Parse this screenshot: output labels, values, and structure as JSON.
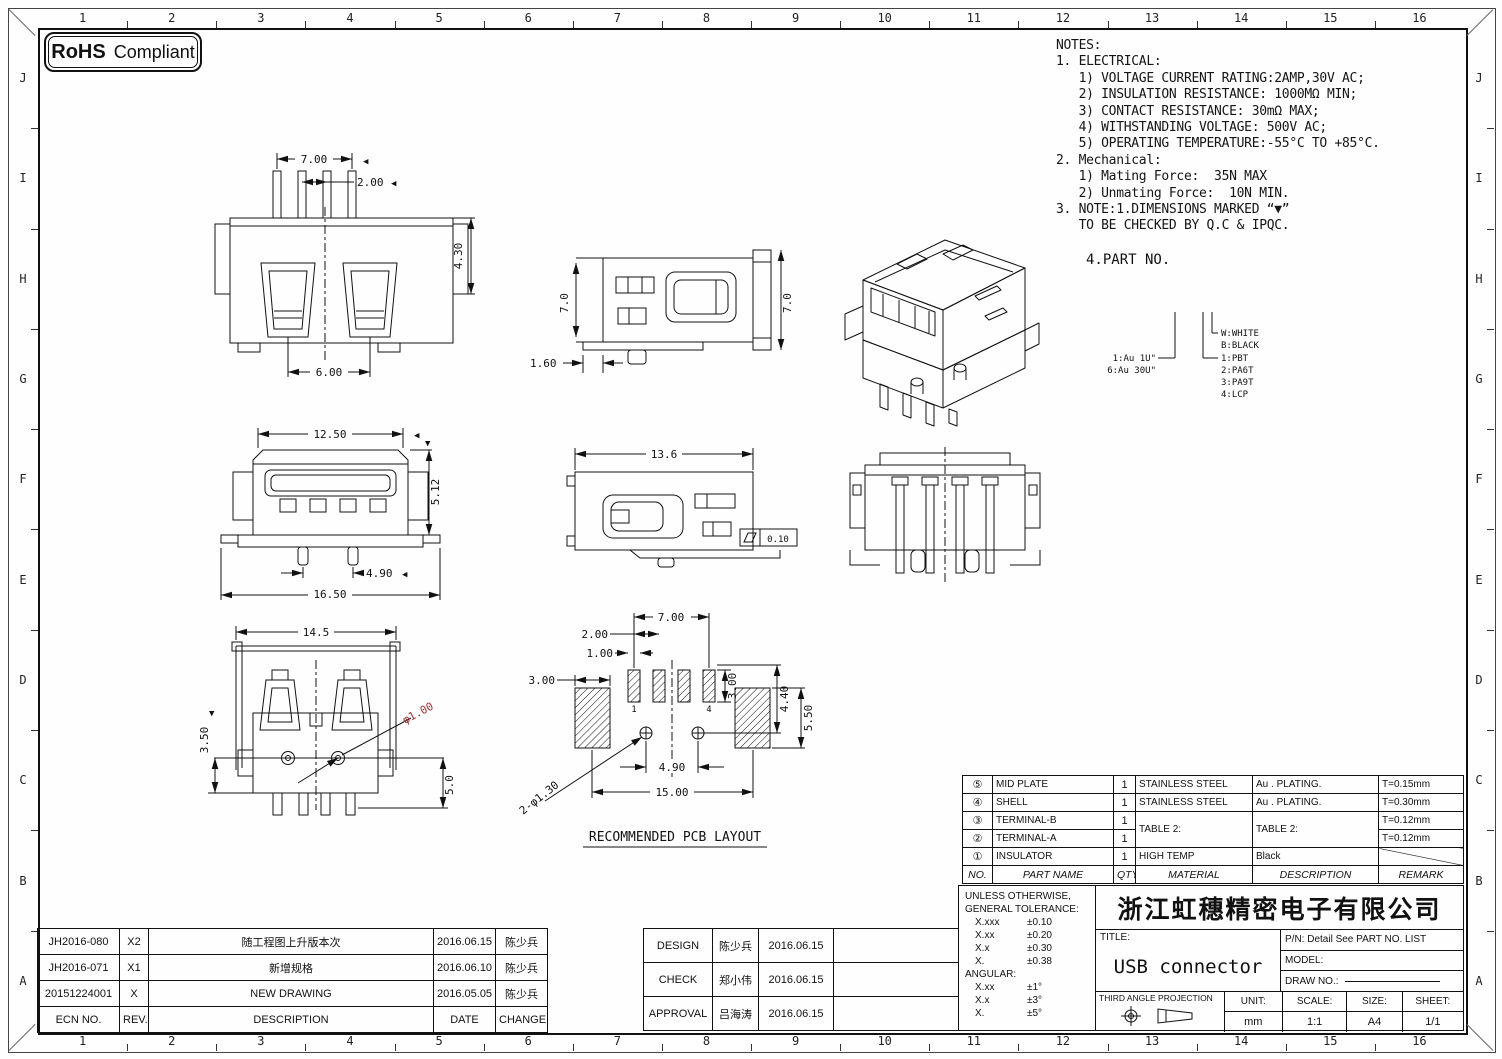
{
  "badge": {
    "rohs": "RoHS",
    "compliant": "Compliant"
  },
  "grid": {
    "cols": [
      "1",
      "2",
      "3",
      "4",
      "5",
      "6",
      "7",
      "8",
      "9",
      "10",
      "11",
      "12",
      "13",
      "14",
      "15",
      "16"
    ],
    "rows": [
      "J",
      "I",
      "H",
      "G",
      "F",
      "E",
      "D",
      "C",
      "B",
      "A"
    ]
  },
  "notes": {
    "lines": [
      "NOTES:",
      "1. ELECTRICAL:",
      "   1) VOLTAGE CURRENT RATING:2AMP,30V AC;",
      "   2) INSULATION RESISTANCE: 1000MΩ MIN;",
      "   3) CONTACT RESISTANCE: 30mΩ MAX;",
      "   4) WITHSTANDING VOLTAGE: 500V AC;",
      "   5) OPERATING TEMPERATURE:-55°C TO +85°C.",
      "2. Mechanical:",
      "   1) Mating Force:  35N MAX",
      "   2) Unmating Force:  10N MIN.",
      "3. NOTE:1.DIMENSIONS MARKED “▼”",
      "   TO BE CHECKED BY Q.C & IPQC."
    ]
  },
  "part_no": {
    "heading": "4.PART NO.",
    "plating": [
      "1:Au 1U\"",
      "6:Au 30U\""
    ],
    "colors": [
      "W:WHITE",
      "B:BLACK"
    ],
    "materials": [
      "1:PBT",
      "2:PA6T",
      "3:PA9T",
      "4:LCP"
    ]
  },
  "views": {
    "rear": {
      "dim_width": "7.00",
      "dim_pitch": "2.00",
      "dim_height": "4.30",
      "dim_slot": "6.00",
      "check_mark": "◀"
    },
    "side": {
      "dim_left": "7.0",
      "dim_right": "7.0",
      "dim_tail": "1.60"
    },
    "front": {
      "dim_width": "12.50",
      "dim_height": "5.12",
      "dim_pins": "4.90",
      "dim_total": "16.50",
      "check_mark": "◀",
      "check_mark_down": "▼"
    },
    "side2": {
      "dim_width": "13.6",
      "flatness_value": "0.10"
    },
    "bottom": {
      "dim_width": "14.5",
      "dim_left": "3.50",
      "dim_hole": "φ1.00",
      "dim_right": "5.0",
      "check_mark_down": "▼"
    },
    "pcb": {
      "title": "RECOMMENDED PCB LAYOUT",
      "dim_width": "7.00",
      "dim_pitch": "2.00",
      "dim_pin": "1.00",
      "dim_pad": "3.00",
      "dim_pin_len": "3.00",
      "dim_row": "4.40",
      "dim_pad_len": "5.50",
      "dim_holes": "4.90",
      "dim_total": "15.00",
      "dim_via": "2-φ1.30",
      "pin1_label": "1",
      "pin4_label": "4"
    }
  },
  "parts_table": {
    "headers": [
      "NO.",
      "PART NAME",
      "QTY",
      "MATERIAL",
      "DESCRIPTION",
      "REMARK"
    ],
    "rows": [
      [
        "⑤",
        "MID PLATE",
        "1",
        "STAINLESS STEEL",
        "Au . PLATING.",
        "T=0.15mm"
      ],
      [
        "④",
        "SHELL",
        "1",
        "STAINLESS STEEL",
        "Au . PLATING.",
        "T=0.30mm"
      ],
      [
        "③",
        "TERMINAL-B",
        "1",
        "TABLE 2:",
        "TABLE 2:",
        "T=0.12mm"
      ],
      [
        "②",
        "TERMINAL-A",
        "1",
        "",
        "",
        "T=0.12mm"
      ],
      [
        "①",
        "INSULATOR",
        "1",
        "HIGH TEMP",
        "Black",
        ""
      ]
    ]
  },
  "tolerance": {
    "line1": "UNLESS OTHERWISE,",
    "line2": "GENERAL TOLERANCE:",
    "general": [
      [
        "X.xxx",
        "±0.10"
      ],
      [
        "X.xx",
        "±0.20"
      ],
      [
        "X.x",
        "±0.30"
      ],
      [
        "X.",
        "±0.38"
      ]
    ],
    "angular_label": "ANGULAR:",
    "angular": [
      [
        "X.xx",
        "±1°"
      ],
      [
        "X.x",
        "±3°"
      ],
      [
        "X.",
        "±5°"
      ]
    ]
  },
  "title_block": {
    "company": "浙江虹穗精密电子有限公司",
    "title_label": "TITLE:",
    "title": "USB connector",
    "pn": "P/N: Detail See PART NO. LIST",
    "model_label": "MODEL:",
    "draw_no_label": "DRAW NO.:",
    "projection_label": "THIRD ANGLE PROJECTION",
    "unit_label": "UNIT:",
    "unit": "mm",
    "scale_label": "SCALE:",
    "scale": "1:1",
    "size_label": "SIZE:",
    "size": "A4",
    "sheet_label": "SHEET:",
    "sheet": "1/1"
  },
  "revisions": {
    "headers": [
      "ECN NO.",
      "REV.",
      "DESCRIPTION",
      "DATE",
      "CHANGE"
    ],
    "rows": [
      [
        "JH2016-080",
        "X2",
        "随工程图上升版本次",
        "2016.06.15",
        "陈少兵"
      ],
      [
        "JH2016-071",
        "X1",
        "新增规格",
        "2016.06.10",
        "陈少兵"
      ],
      [
        "20151224001",
        "X",
        "NEW DRAWING",
        "2016.05.05",
        "陈少兵"
      ]
    ]
  },
  "approvals": {
    "rows": [
      [
        "DESIGN",
        "陈少兵",
        "2016.06.15"
      ],
      [
        "CHECK",
        "郑小伟",
        "2016.06.15"
      ],
      [
        "APPROVAL",
        "吕海涛",
        "2016.06.15"
      ]
    ]
  },
  "colors": {
    "line": "#111111",
    "accent_red": "#9b3434"
  }
}
